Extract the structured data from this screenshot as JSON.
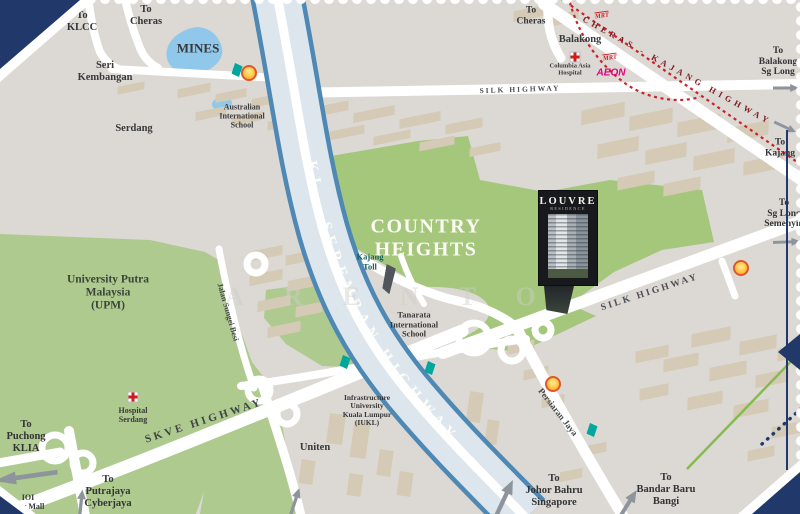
{
  "marker": {
    "title": "LOUVRE",
    "subtitle": "RESIDENCE"
  },
  "watermark": "ARENTO",
  "areas": {
    "country_heights": "COUNTRY\nHEIGHTS",
    "upm": "University Putra\nMalaysia\n(UPM)"
  },
  "roads": {
    "kl_seremban": "KL - SEREMBAN HIGHWAY",
    "silk_top": "SILK HIGHWAY",
    "silk_main": "SILK HIGHWAY",
    "cheras_kajang": "CHERAS - KAJANG HIGHWAY",
    "skve": "SKVE HIGHWAY",
    "persiaran_jaya": "Persiaran Jaya",
    "jalan_sungei_besi": "Jalan Sungei Besi"
  },
  "places": {
    "mines": "MINES",
    "seri_kembangan": "Seri\nKembangan",
    "serdang": "Serdang",
    "balakong": "Balakong",
    "australian_school": "Australian\nInternational\nSchool",
    "columbia_hospital": "Columbia Asia\nHospital",
    "aeon": "AEON",
    "mrt": "MRT",
    "kajang_toll": "Kajang\nToll",
    "tanarata": "Tanarata\nInternational\nSchool",
    "hospital_serdang": "Hospital\nSerdang",
    "ioi_city_mall": "IOI\nCity Mall",
    "iukl": "Infrastructure\nUniversity\nKuala Lumpur\n(IUKL)",
    "uniten": "Uniten"
  },
  "directions": {
    "to_klcc": "To\nKLCC",
    "to_cheras_nw": "To\nCheras",
    "to_cheras_n": "To\nCheras",
    "to_balakong_sg_long": "To\nBalakong\nSg Long",
    "to_kajang": "To\nKajang",
    "to_sg_long_semenyih": "To\nSg Long\nSemenyih",
    "to_puchong_klia": "To\nPuchong\nKLIA",
    "to_putrajaya": "To\nPutrajaya\nCyberjaya",
    "to_johor": "To\nJohor Bahru\nSingapore",
    "to_bandar_baru": "To\nBandar Baru\nBangi"
  },
  "colors": {
    "navy": "#20396a",
    "green_zone": "#a4c77c",
    "green_light": "#aeca8e",
    "lake": "#8fc8ea",
    "road_blue": "#4e88b4",
    "red_dotted": "#cf2027",
    "green_line": "#84bb4d",
    "mrt_red": "#d42027",
    "aeon_pink": "#e0007f",
    "shell_yellow": "#fcb32c",
    "petronas_teal": "#00a79d",
    "marker_bg": "#17191c"
  }
}
